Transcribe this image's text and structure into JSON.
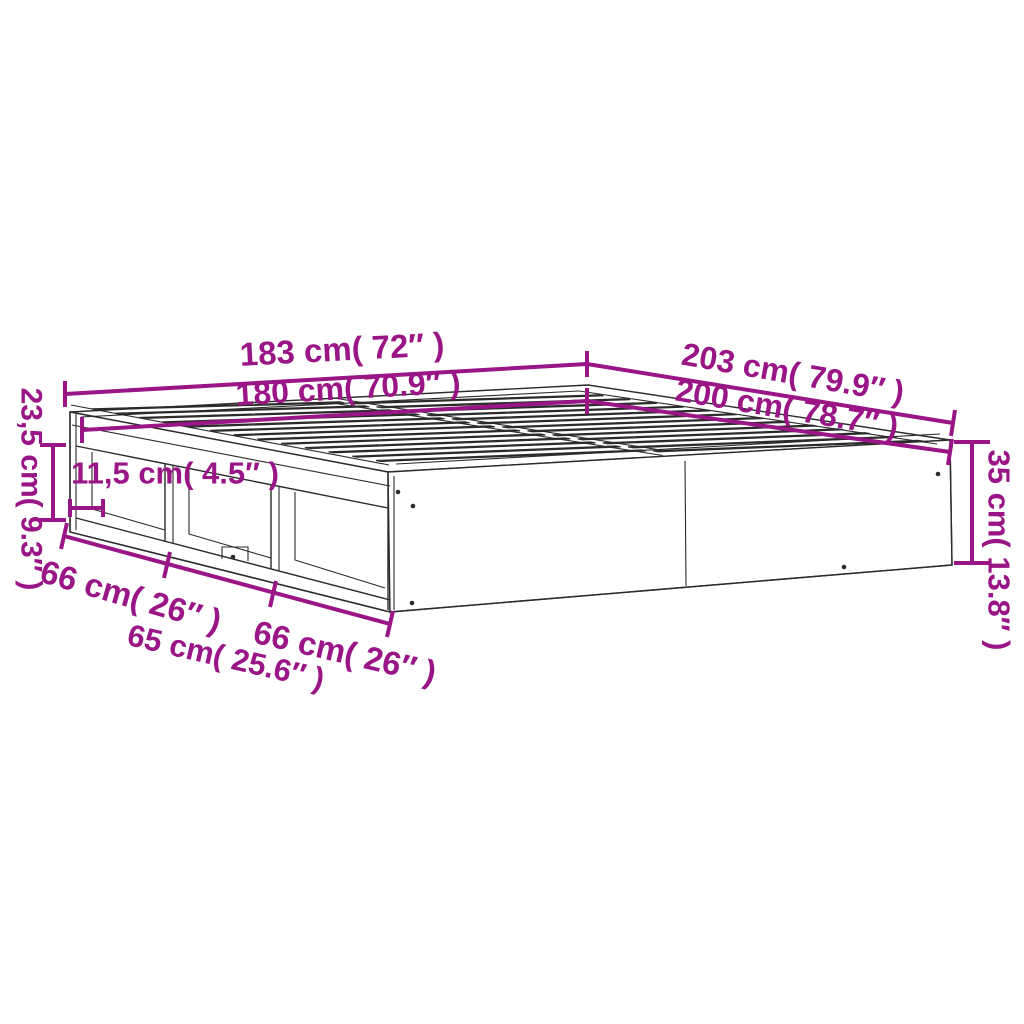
{
  "diagram": {
    "type": "product-dimension-diagram",
    "subject": "bed-frame-isometric-view",
    "accent_color": "#9A1585",
    "line_color": "#2B2B2B",
    "background_color": "#FFFFFF",
    "labels": {
      "overall_width": "183 cm( 72″ )",
      "inner_width": "180 cm( 70.9″ )",
      "overall_length": "203 cm( 79.9″ )",
      "inner_length": "200 cm( 78.7″ )",
      "side_opening_height": "23,5 cm( 9.3″ )",
      "shelf_depth": "11,5 cm( 4.5″ )",
      "frame_height": "35 cm( 13.8″ )",
      "compartment_left": "66 cm( 26″ )",
      "compartment_middle": "65 cm( 25.6″ )",
      "compartment_right": "66 cm( 26″ )"
    }
  }
}
